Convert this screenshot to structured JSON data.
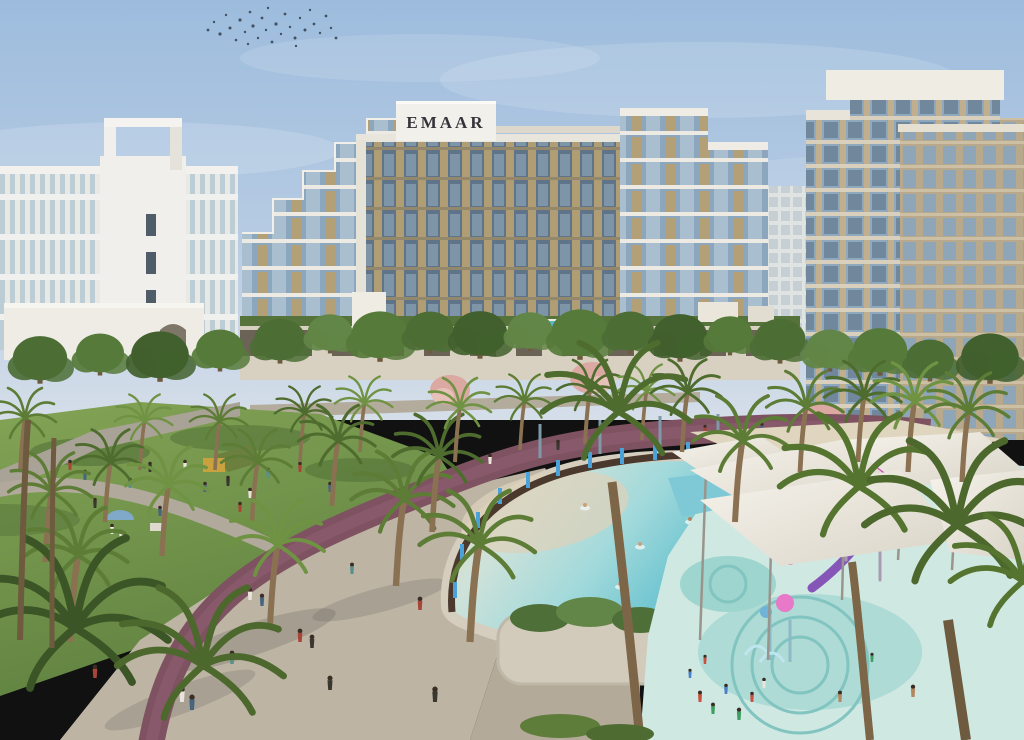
{
  "scene": {
    "type": "architectural-render",
    "sign_text": "EMAAR"
  },
  "colors": {
    "sky_top": "#9dbcdd",
    "sky_mid": "#b6cbe3",
    "sky_horizon": "#d5dee9",
    "building_white": "#e9e8e3",
    "building_tan": "#b3a076",
    "glass_blue": "#8ca9bf",
    "glass_dark": "#5f7488",
    "lawn_green": "#6f9444",
    "lawn_light": "#83a455",
    "tree_dark": "#41602d",
    "tree_mid": "#567a39",
    "tree_light": "#6c9247",
    "palm_green": "#5d7c36",
    "pink_tree": "#dba8a2",
    "track_purple": "#7e5260",
    "path_gray": "#bcb3a4",
    "pool_sand": "#dfd5bd",
    "pool_water": "#63c0ce",
    "pool_deep": "#3fa6bc",
    "canopy_white": "#f6f3ec",
    "slide_magenta": "#c84fb2",
    "slide_purple": "#8655b8",
    "post_blue": "#4aa2d8",
    "wall_brown": "#4a392c",
    "splash_ground": "#cfe8e2"
  }
}
